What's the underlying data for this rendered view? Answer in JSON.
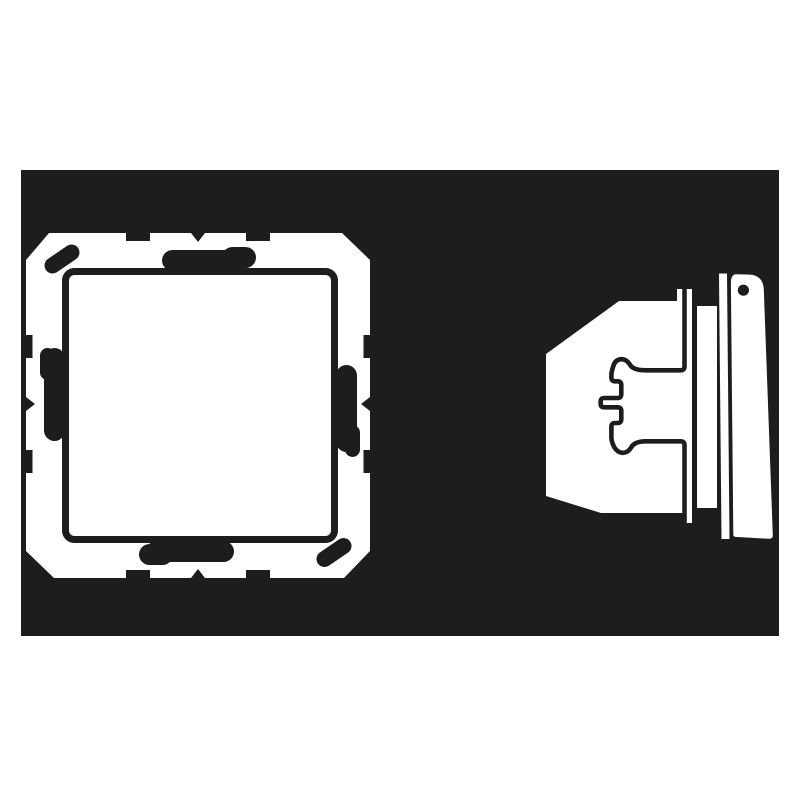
{
  "illustration": {
    "subject": "Flush-mounted rocker switch pictogram - front view and side profile view",
    "views": [
      {
        "name": "switch-front-view"
      },
      {
        "name": "switch-side-view"
      }
    ]
  },
  "colors": {
    "ink": "#1d1d1b",
    "paper": "#ffffff"
  }
}
